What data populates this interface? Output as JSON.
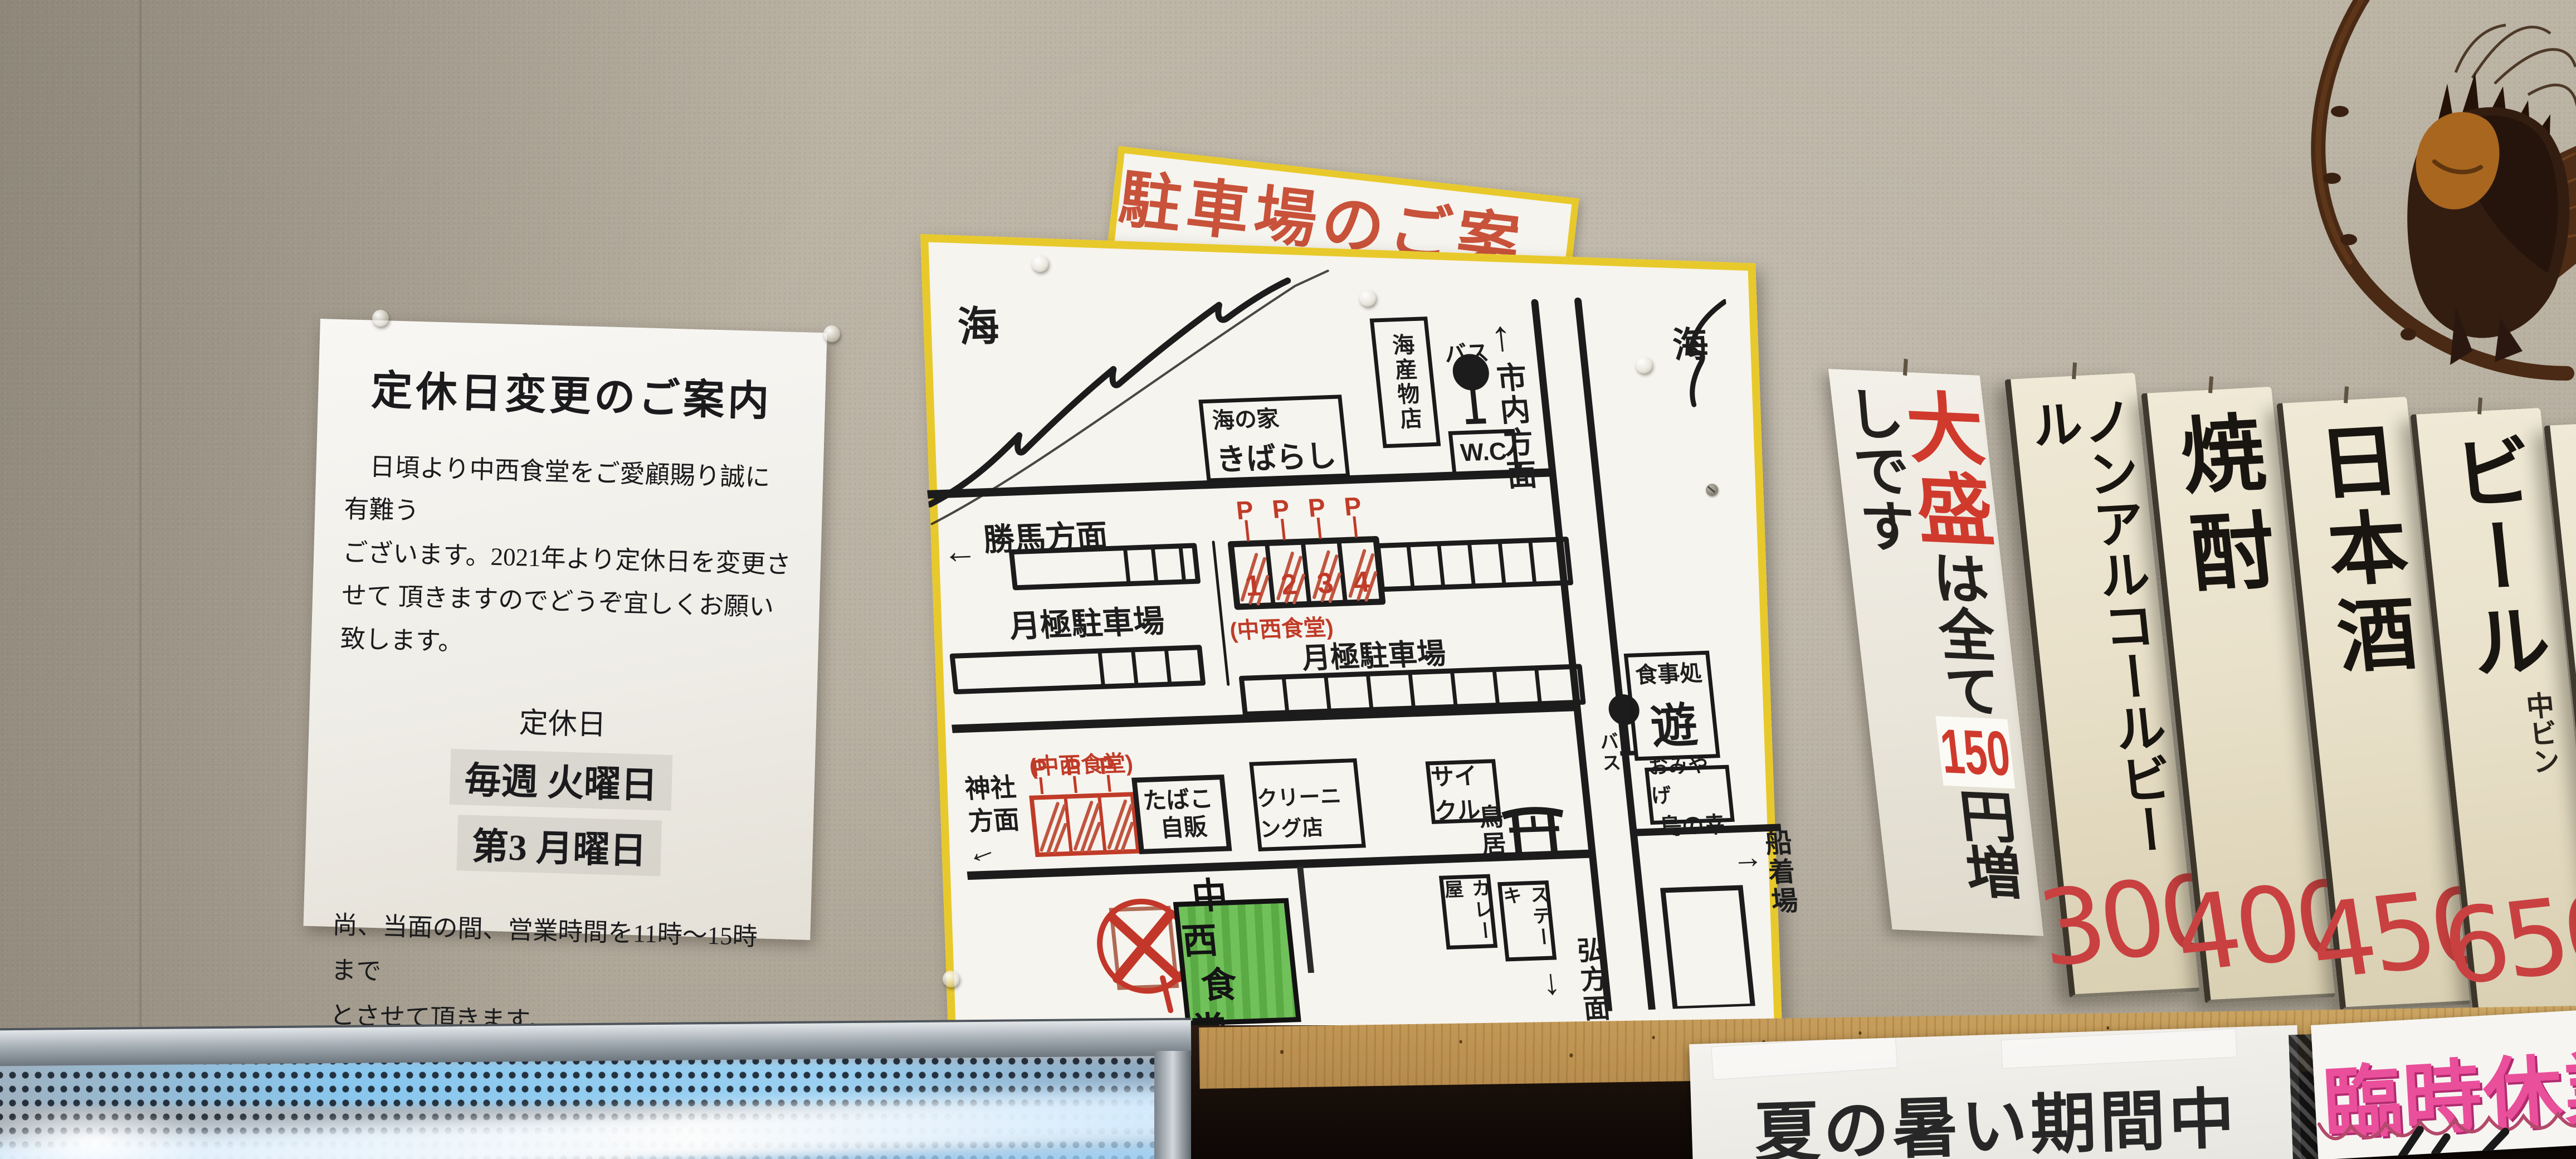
{
  "notice": {
    "title": "定休日変更のご案内",
    "body_line1": "日頃より中西食堂をご愛顧賜り誠に有難う",
    "body_line2": "ございます。2021年より定休日を変更させて",
    "body_line3": "頂きますのでどうぞ宜しくお願い致します。",
    "closed_heading": "定休日",
    "closed_weekly": "毎週 火曜日",
    "closed_monthly": "第3  月曜日",
    "note_line1": "尚、当面の間、営業時間を11時～15時まで",
    "note_line2": "とさせて頂きます。",
    "signature": "中西食堂"
  },
  "map": {
    "title": "駐車場のご案内",
    "sea_left": "海",
    "sea_right": "海",
    "dir_katsuma": "勝馬方面",
    "dir_city": "市内方面",
    "dir_shrine": "神社\n方面",
    "dir_hiro": "弘方面",
    "dir_pier": "船着場",
    "arrows": {
      "left": "←",
      "up": "↑",
      "right": "→",
      "down": "↓"
    },
    "beach_house_line1": "海の家",
    "beach_house_line2": "きばらし",
    "seafood_shop": "海産物店",
    "wc": "W.C",
    "bus1": "バス",
    "bus2": "バス",
    "tsukigime_left": "月極駐車場",
    "tsukigime_right": "月極駐車場",
    "nakanishi_paren_left": "(中西食堂)",
    "nakanishi_paren_right": "(中西食堂)",
    "stall_numbers": [
      "1",
      "2",
      "3",
      "4"
    ],
    "p_flag": "P",
    "tobacco_line1": "たばこ",
    "tobacco_line2": "自販",
    "cleaning_shop": "クリーニング店",
    "cycle_shop": "サイクル",
    "torii": "鳥居",
    "restaurant_line1": "中西",
    "restaurant_line2": "食堂",
    "curry_shop": "カレー屋",
    "steak_shop": "ステーキ",
    "restaurant_yu_line1": "食事処",
    "restaurant_yu_line2": "遊",
    "souvenir_line1": "おみやげ",
    "souvenir_line2": "島の幸"
  },
  "menu": {
    "oomori": {
      "prefix": "大盛",
      "middle": "は全て",
      "price": "150",
      "suffix": "円増しです"
    },
    "boards": [
      {
        "name": "ノンアルコールビール",
        "price": "300"
      },
      {
        "name": "焼酎",
        "price": "400"
      },
      {
        "name": "日本酒",
        "price": "450"
      },
      {
        "name": "ビール",
        "size_note": "中ビン",
        "price": "650"
      },
      {
        "name": "ライス",
        "size_note": "小",
        "price": ""
      }
    ]
  },
  "bottom_signs": {
    "summer": "夏の暑い期間中",
    "temporary_closed": "臨時休業"
  },
  "colors": {
    "map_border_yellow": "#e8c92b",
    "map_red": "#c03b28",
    "restaurant_green": "#5aab46",
    "menu_price_red": "#c94040",
    "rinji_pink": "#ea4f9b",
    "board_cream": "#e9e1ca"
  }
}
